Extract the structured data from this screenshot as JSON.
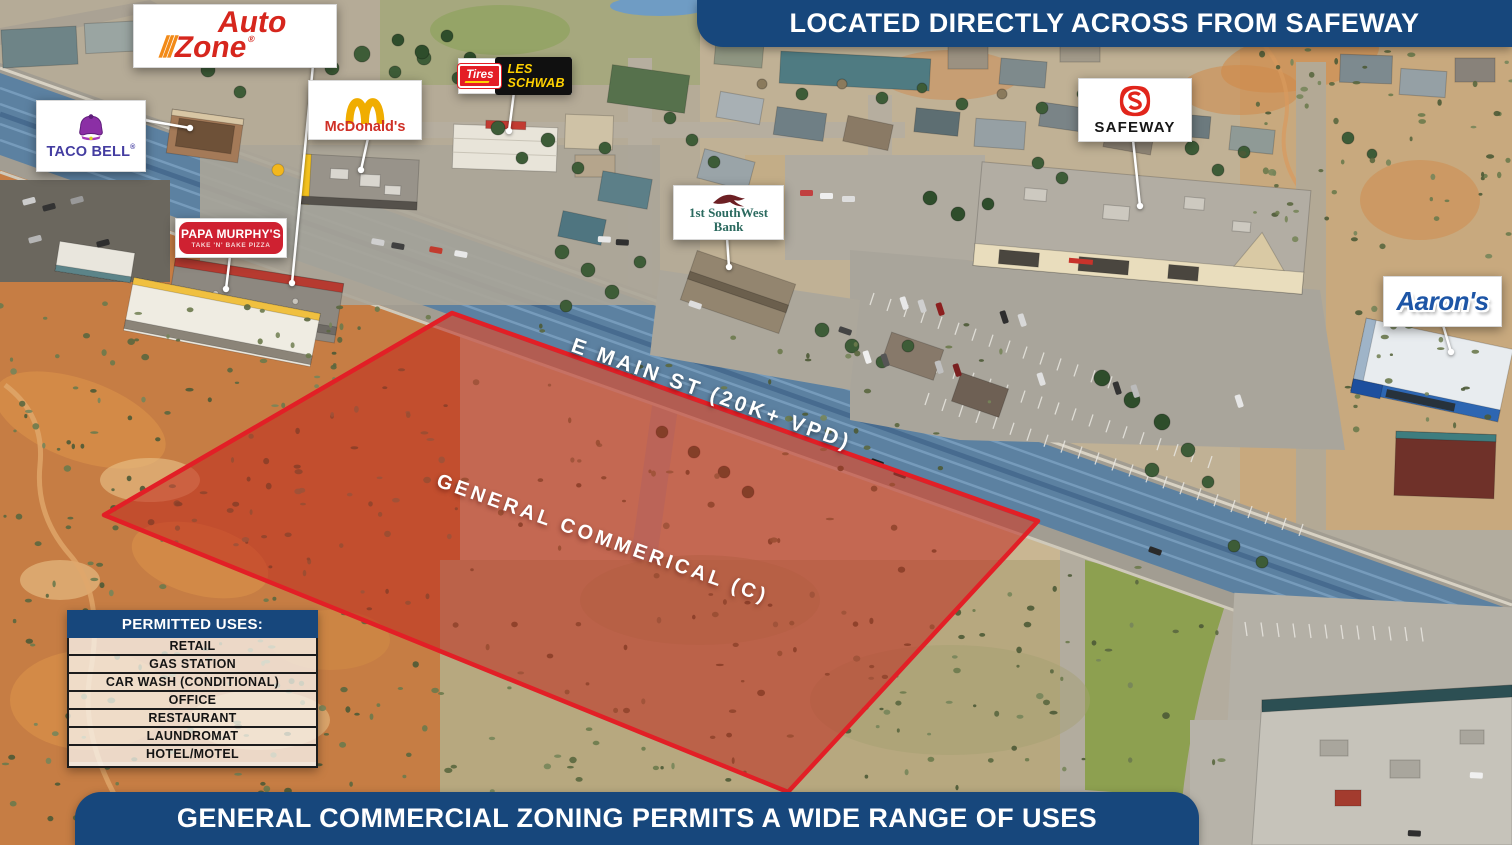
{
  "top_banner": {
    "text": "LOCATED DIRECTLY ACROSS FROM SAFEWAY"
  },
  "bottom_banner": {
    "text": "GENERAL COMMERCIAL ZONING PERMITS A WIDE RANGE OF USES"
  },
  "overlays": {
    "road_label": "E MAIN ST (20K+ VPD)",
    "parcel_label": "GENERAL COMMERICAL (C)"
  },
  "permitted_uses": {
    "header": "PERMITTED USES:",
    "items": [
      "RETAIL",
      "GAS STATION",
      "CAR WASH (CONDITIONAL)",
      "OFFICE",
      "RESTAURANT",
      "LAUNDROMAT",
      "HOTEL/MOTEL"
    ]
  },
  "callouts": {
    "autozone": {
      "name": "AutoZone",
      "line1": "Auto",
      "line2": "Zone",
      "reg": "®"
    },
    "taco_bell": {
      "name": "TACO BELL",
      "reg": "®"
    },
    "mcdonalds": {
      "name": "McDonald's"
    },
    "les_schwab": {
      "tires": "Tires",
      "name": "LES SCHWAB"
    },
    "papa_murphys": {
      "name": "PAPA MURPHY'S",
      "tagline": "TAKE 'N' BAKE PIZZA"
    },
    "first_southwest_bank": {
      "line1": "1st SouthWest",
      "line2": "Bank"
    },
    "safeway": {
      "name": "SAFEWAY"
    },
    "aarons": {
      "name": "Aaron's"
    }
  },
  "colors": {
    "banner_navy": "#17477c",
    "parcel_red_border": "#e21f26",
    "parcel_red_fill": "#c0281e",
    "road_tint": "#567fa3",
    "autozone_red": "#d6261d",
    "autozone_orange": "#f28a17",
    "tacobell_purple": "#8b2fa5",
    "tacobell_text": "#443da1",
    "mcdonalds_gold": "#f0ad00",
    "mcdonalds_red": "#cf3027",
    "lesschwab_red": "#e41d25",
    "lesschwab_yellow": "#ffd200",
    "papamurphys_red": "#cf2131",
    "bank_teal": "#2b6a5f",
    "bank_bird_red": "#6d2024",
    "safeway_red": "#e1251b",
    "aarons_blue": "#1d55a6"
  }
}
